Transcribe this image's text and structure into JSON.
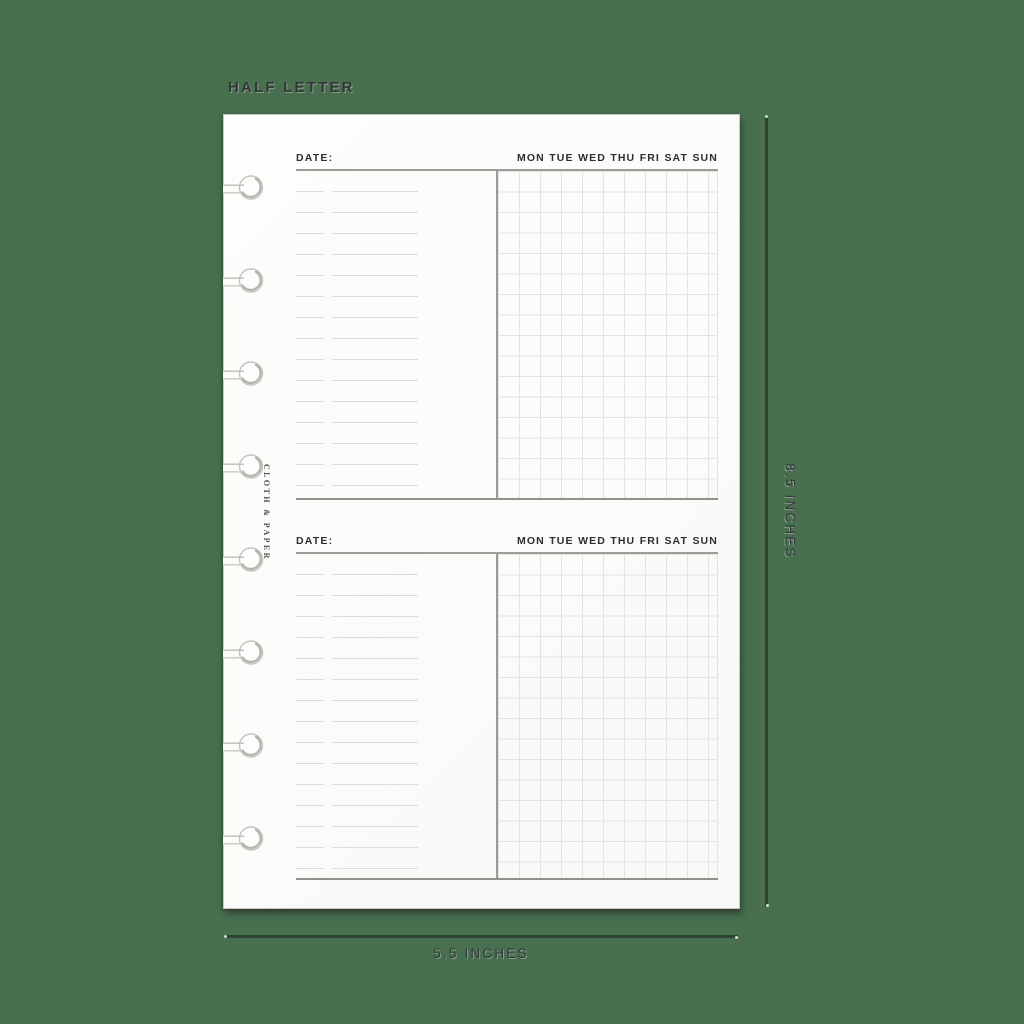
{
  "annotations": {
    "size_label": "HALF LETTER",
    "height_label": "8.5 INCHES",
    "width_label": "5.5 INCHES"
  },
  "brand": {
    "name": "CLOTH & PAPER"
  },
  "page": {
    "type": "weekly-tracker-insert",
    "sections": [
      {
        "date_label": "DATE:",
        "days": [
          "MON",
          "TUE",
          "WED",
          "THU",
          "FRI",
          "SAT",
          "SUN"
        ]
      },
      {
        "date_label": "DATE:",
        "days": [
          "MON",
          "TUE",
          "WED",
          "THU",
          "FRI",
          "SAT",
          "SUN"
        ]
      }
    ],
    "punch_count": 8
  },
  "colors": {
    "background": "#48704F",
    "paper": "#fbfbf9",
    "rule_dark": "#90908d",
    "grid_line": "#e3e3e1",
    "note_line": "#dcdcda",
    "annotation_text": "#323639",
    "dimension_line": "#363e3a"
  }
}
